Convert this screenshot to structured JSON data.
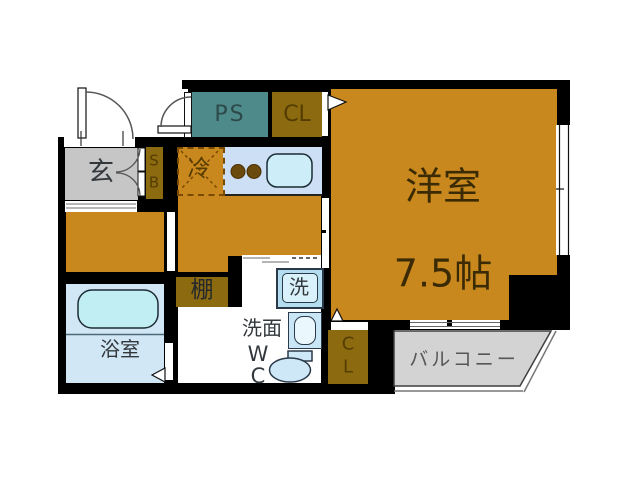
{
  "plan": {
    "title": "1K apartment floor plan",
    "rooms": {
      "genkan": {
        "label": "玄"
      },
      "shoe_box": {
        "label": "S\nB"
      },
      "pipe_space": {
        "label": "PS"
      },
      "closet_top": {
        "label": "CL"
      },
      "fridge": {
        "label": "冷"
      },
      "western_room": {
        "label": "洋室",
        "size": "7.5帖"
      },
      "shelf": {
        "label": "棚"
      },
      "washer": {
        "label": "洗"
      },
      "washroom": {
        "label": "洗面"
      },
      "wc": {
        "label": "W\nC"
      },
      "bathroom": {
        "label": "浴室"
      },
      "closet_bottom": {
        "label": "C\nL"
      },
      "balcony": {
        "label": "バルコニー"
      }
    },
    "colors": {
      "wall_black": "#000000",
      "floor_orange": "#C9881D",
      "cabinet_olive": "#8B6A10",
      "pipe_space_teal": "#4F8A8A",
      "genkan_gray": "#C6C6C6",
      "balcony_gray": "#D3D3D3",
      "water_blue": "#D2E7F5",
      "tub_cyan": "#C0EEF2"
    }
  }
}
